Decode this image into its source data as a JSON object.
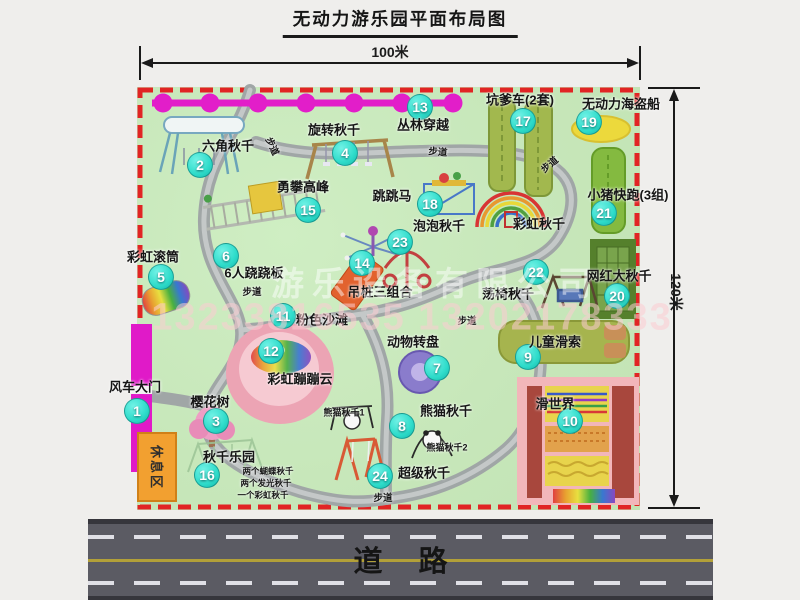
{
  "title": "无动力游乐园平面布局图",
  "dimensions": {
    "width": "100米",
    "height": "120米"
  },
  "road": {
    "label": "道路"
  },
  "watermark": {
    "company": "游乐设备有限公司",
    "phone": "13233816535 13202178333"
  },
  "labels": {
    "footpath": "步道",
    "rest_area": "休息区",
    "rainbow_swing": "彩虹秋千",
    "panda_swing_1": "熊猫秋千1",
    "panda_swing_2": "熊猫秋千2"
  },
  "swing_park_notes": [
    "两个蝴蝶秋千",
    "两个发光秋千",
    "一个彩虹秋千"
  ],
  "attractions": [
    {
      "num": "1",
      "name": "风车大门"
    },
    {
      "num": "2",
      "name": "六角秋千"
    },
    {
      "num": "3",
      "name": "樱花树"
    },
    {
      "num": "4",
      "name": "旋转秋千"
    },
    {
      "num": "5",
      "name": "彩虹滚筒"
    },
    {
      "num": "6",
      "name": "6人跷跷板"
    },
    {
      "num": "7",
      "name": "动物转盘"
    },
    {
      "num": "8",
      "name": "熊猫秋千"
    },
    {
      "num": "9",
      "name": "儿童滑索"
    },
    {
      "num": "10",
      "name": "滑世界"
    },
    {
      "num": "11",
      "name": "粉色沙滩"
    },
    {
      "num": "12",
      "name": "彩虹蹦蹦云"
    },
    {
      "num": "13",
      "name": "丛林穿越"
    },
    {
      "num": "14",
      "name": "吊桩三组合"
    },
    {
      "num": "15",
      "name": "勇攀高峰"
    },
    {
      "num": "16",
      "name": "秋千乐园"
    },
    {
      "num": "17",
      "name": "坑爹车(2套)"
    },
    {
      "num": "18",
      "name": "跳跳马"
    },
    {
      "num": "19",
      "name": "无动力海盗船"
    },
    {
      "num": "20",
      "name": "网红大秋千"
    },
    {
      "num": "21",
      "name": "小猪快跑(3组)"
    },
    {
      "num": "22",
      "name": "荡椅秋千"
    },
    {
      "num": "23",
      "name": "泡泡秋千"
    },
    {
      "num": "24",
      "name": "超级秋千"
    }
  ]
}
